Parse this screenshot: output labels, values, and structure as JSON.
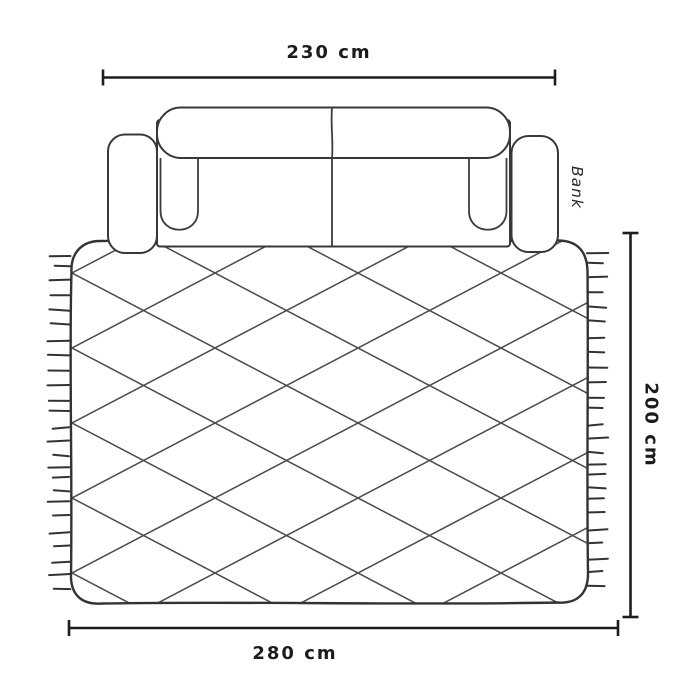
{
  "diagram": {
    "background": "#ffffff",
    "sofa": {
      "label": "Bank",
      "width_dimension": "230 cm"
    },
    "rug": {
      "width_dimension": "280 cm",
      "height_dimension": "200 cm",
      "pattern": "diamond-lattice",
      "fringes": "left-and-right-edges"
    },
    "colors": {
      "outline": "#383838",
      "pattern_line": "#4b4b4b",
      "dimension_line": "#1d1d1d",
      "label_text": "#1c1c1c"
    }
  }
}
